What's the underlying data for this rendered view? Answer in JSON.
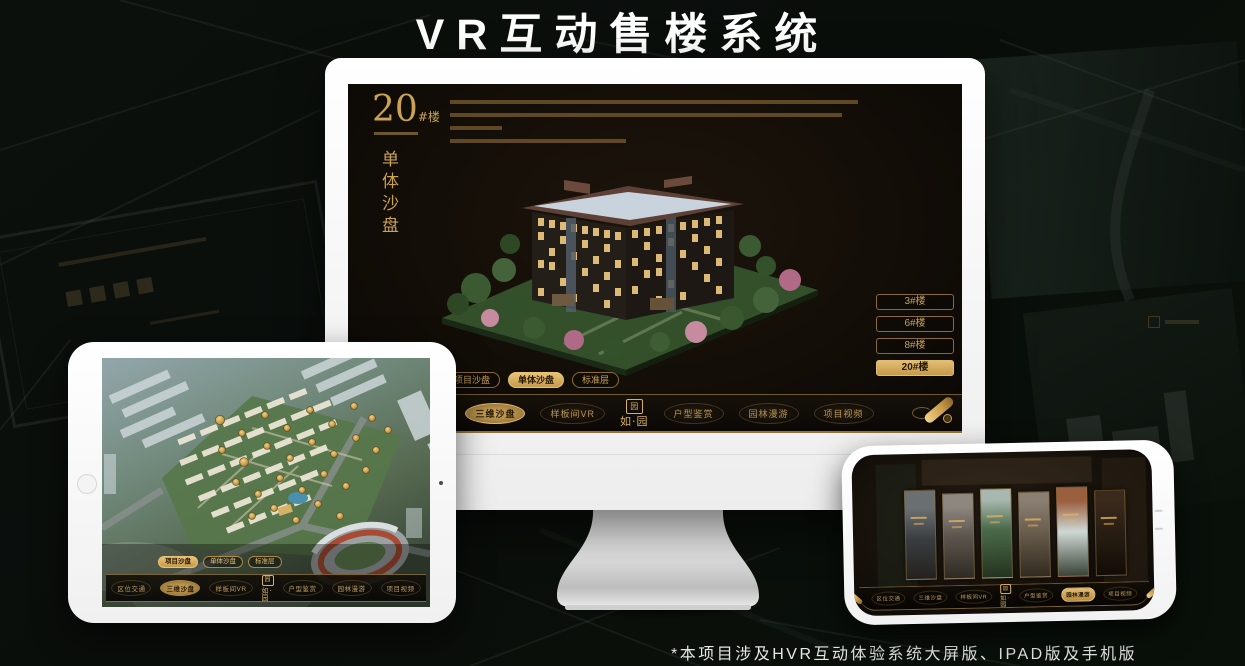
{
  "page": {
    "title": "VR互动售楼系统",
    "footnote": "*本项目涉及HVR互动体验系统大屏版、IPAD版及手机版"
  },
  "colors": {
    "accent_gold": "#c9a254",
    "accent_gold_bright": "#e3bd73",
    "screen_background": "#17110b"
  },
  "nav": {
    "logo_text": "如·园",
    "items": [
      {
        "label": "区位交通"
      },
      {
        "label": "三维沙盘"
      },
      {
        "label": "样板间VR"
      },
      {
        "label": "户型鉴赏"
      },
      {
        "label": "园林漫游"
      },
      {
        "label": "项目视频"
      }
    ]
  },
  "monitor": {
    "building_number": "20",
    "building_unit": "#楼",
    "section_title": "单体沙盘",
    "floor_buttons": [
      {
        "label": "3#楼",
        "active": false
      },
      {
        "label": "6#楼",
        "active": false
      },
      {
        "label": "8#楼",
        "active": false
      },
      {
        "label": "20#楼",
        "active": true
      }
    ],
    "tabs": [
      {
        "label": "项目沙盘",
        "active": false
      },
      {
        "label": "单体沙盘",
        "active": true
      },
      {
        "label": "标准层",
        "active": false
      }
    ],
    "active_nav": "三维沙盘"
  },
  "tablet": {
    "tabs": [
      {
        "label": "项目沙盘",
        "active": true
      },
      {
        "label": "单体沙盘",
        "active": false
      },
      {
        "label": "标准层",
        "active": false
      }
    ],
    "active_nav": "三维沙盘"
  },
  "phone": {
    "active_nav": "园林漫游"
  }
}
